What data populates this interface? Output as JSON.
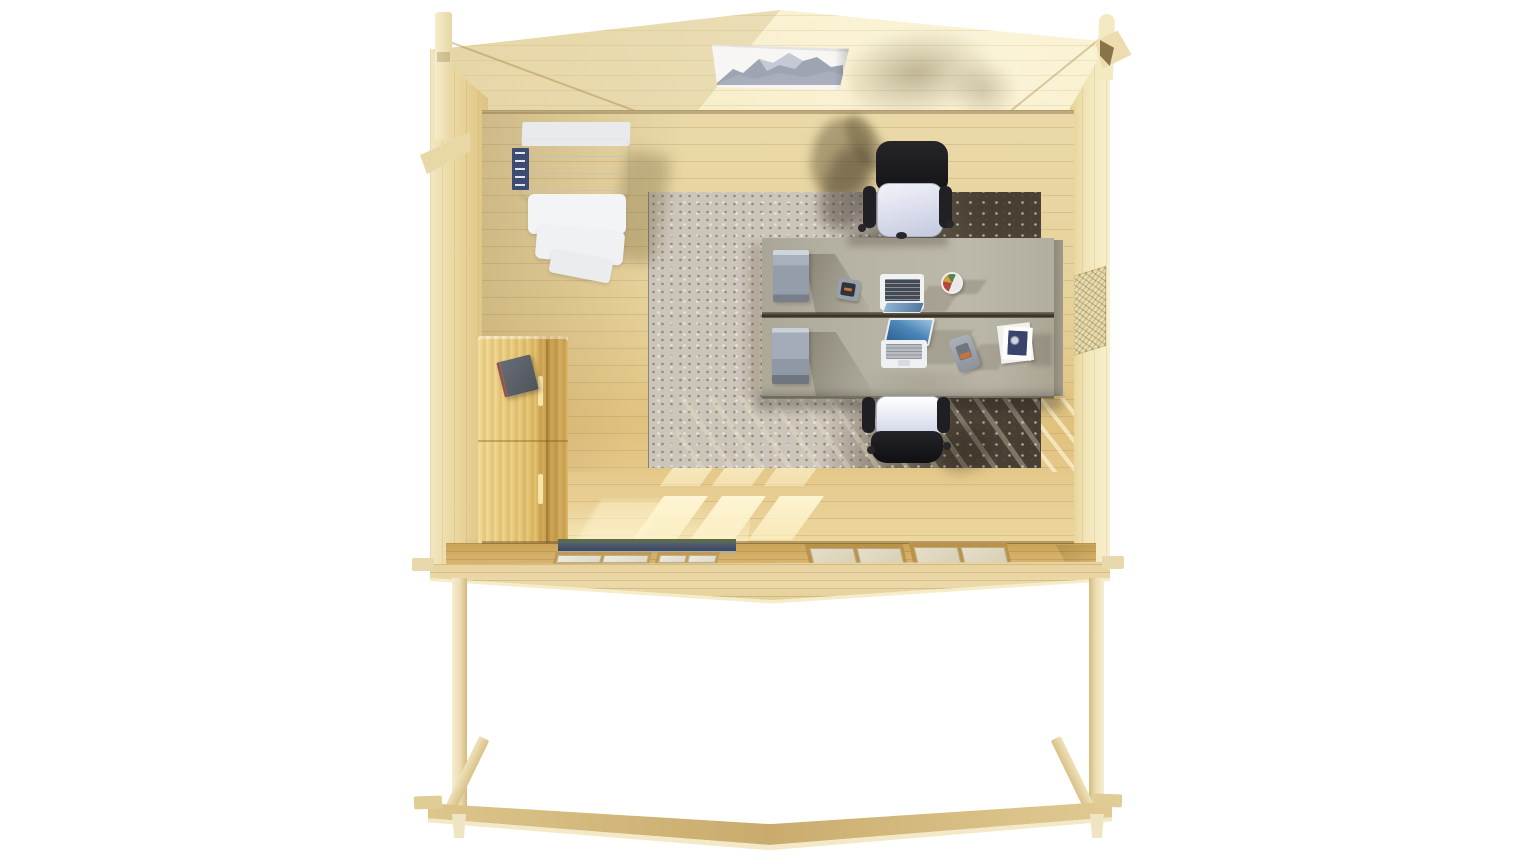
{
  "scene": {
    "description": "Top-down 3D architectural render of a timber log-cabin garden office with front pergola, viewed from directly above with the roof removed",
    "background_color": "#ffffff",
    "visible_text": ""
  },
  "palette": {
    "wall_wood": "#f1e2b0",
    "left_wall_wood": "#e8d49e",
    "right_wall_wood": "#f3e7bd",
    "floor_wood": "#e6d39e",
    "floor_sunlit": "#e8cd8d",
    "front_wall_wood": "#d2ac63",
    "deck_wood": "#e9d6a2",
    "pergola_beam": "#cfb275",
    "rug_light": "#ccc5b9",
    "rug_dark": "#5f5546",
    "rug_navy_patch": "#34384a",
    "desk_top": "#b5b1a2",
    "desk_seam": "#3e362a",
    "drawer_unit_gray": "#98a1ae",
    "chair_seat": "#dcdfee",
    "chair_frame_black": "#1d1d20",
    "shelf_unit_white": "#f6f7f8",
    "books_navy": "#3e4c74",
    "tall_cabinet_wood": "#e3bd68",
    "cabinet_object_slate": "#5c6068",
    "laptop_screen_blue": "#3a7fb5",
    "laptop_keyboard_dark": "#434a54",
    "door_track_blue": "#46506a",
    "door_track_green": "#5a6b50",
    "window_pane": "#e9e6dc",
    "picture_mountain_gray": "#8e96a6",
    "phone_orange_accent": "#c9713b"
  },
  "objects": {
    "cabin": {
      "label": "cabin interior seen from above"
    },
    "roof_gable": {
      "label": "gabled back wall and roof edge"
    },
    "left_wall": {
      "label": "left side wall"
    },
    "right_wall": {
      "label": "right side wall"
    },
    "floor": {
      "label": "wooden plank floor"
    },
    "rug": {
      "label": "large mottled area rug"
    },
    "picture": {
      "label": "framed mountain picture on back wall"
    },
    "shelf_unit": {
      "label": "white shelving unit in top-left corner"
    },
    "books": {
      "label": "dark blue binders beside shelving unit"
    },
    "tall_cabinet": {
      "label": "tall wooden storage cabinet on left wall"
    },
    "cabinet_object": {
      "label": "dark folder lying on cabinet top"
    },
    "desk_far": {
      "label": "far desk workstation"
    },
    "desk_near": {
      "label": "near desk workstation"
    },
    "drawer_far": {
      "label": "gray drawer pedestal on far desk"
    },
    "drawer_near": {
      "label": "gray drawer pedestal on near desk"
    },
    "laptop_far": {
      "label": "open laptop on far desk"
    },
    "laptop_near": {
      "label": "open laptop on near desk"
    },
    "phone_far": {
      "label": "desk phone on far desk"
    },
    "phone_near": {
      "label": "desk phone on near desk"
    },
    "mug": {
      "label": "pencil cup on far desk"
    },
    "papers": {
      "label": "stack of papers and magazine on near desk"
    },
    "chair_far": {
      "label": "office chair at far desk"
    },
    "chair_near": {
      "label": "office chair at near desk"
    },
    "vent": {
      "label": "ventilation grille on right wall"
    },
    "door_track": {
      "label": "sliding glass door track in front wall"
    },
    "window_left_group": {
      "label": "left front windows"
    },
    "window_right_group": {
      "label": "right front windows"
    },
    "deck_edge": {
      "label": "front deck edge"
    },
    "post_left": {
      "label": "left pergola post"
    },
    "post_right": {
      "label": "right pergola post"
    },
    "brace_left": {
      "label": "left diagonal brace"
    },
    "brace_right": {
      "label": "right diagonal brace"
    },
    "beam": {
      "label": "front pergola beam"
    },
    "corner_joint_left": {
      "label": "interlocking log corner joint, top left"
    },
    "corner_joint_right": {
      "label": "interlocking log corner joint, top right"
    }
  }
}
